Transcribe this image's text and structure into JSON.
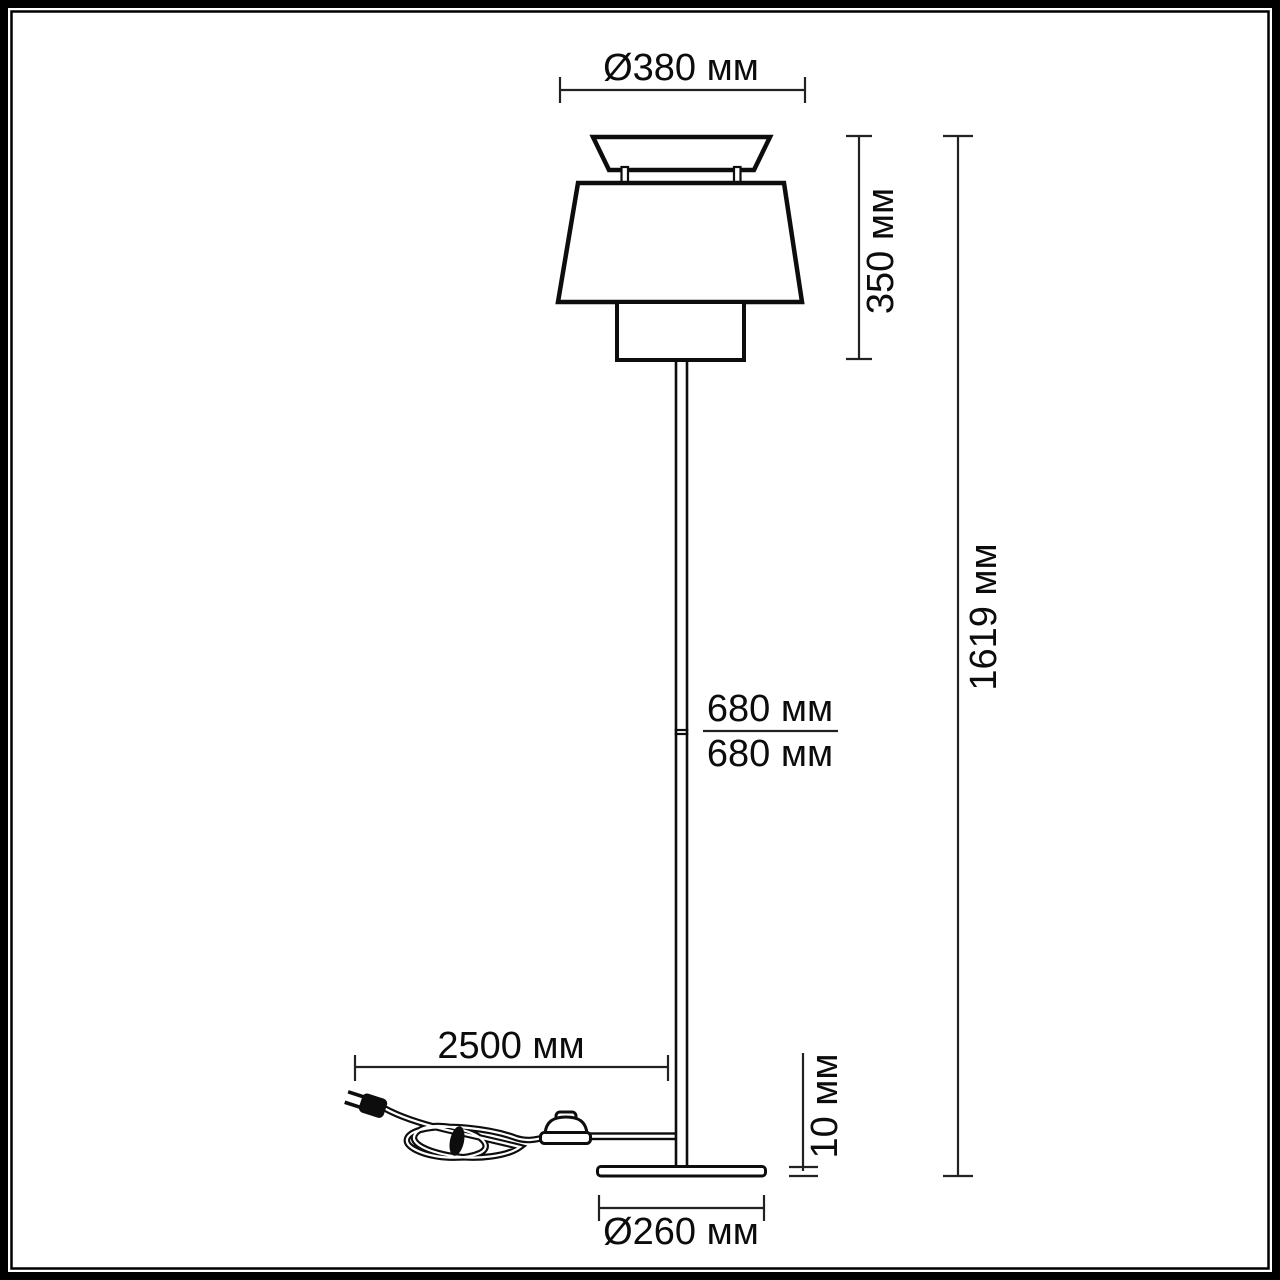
{
  "drawing": {
    "kind": "floor-lamp-dimension-diagram",
    "ink_color": "#0d0d0d",
    "dimension_line_color": "#222222",
    "background_color": "#ffffff"
  },
  "labels": {
    "shade_diameter": "Ø380 мм",
    "shade_height": "350 мм",
    "total_height": "1619 мм",
    "upper_pole_length": "680 мм",
    "lower_pole_length": "680 мм",
    "cord_length": "2500 мм",
    "base_thickness": "10 мм",
    "base_diameter": "Ø260 мм"
  }
}
